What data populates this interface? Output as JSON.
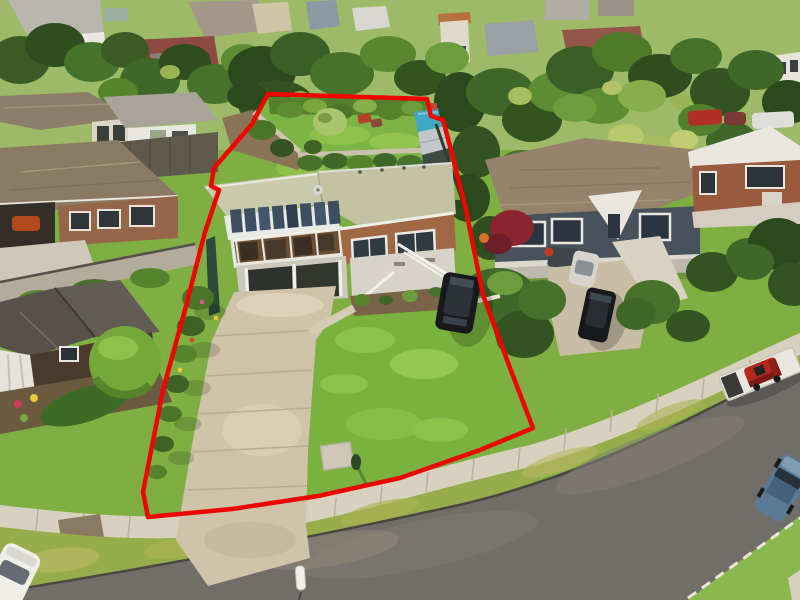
{
  "image": {
    "kind": "aerial-drone-photograph",
    "scene": "Suburban residential street viewed from above with a red property-boundary outline drawn around one lot",
    "subject_lot": "Split-level brick house with glass conservatory, double garage, long concrete driveway, large rear lawn with gardens and sheds, large front lawn",
    "no_text_visible": true
  },
  "colors": {
    "boundary": "#ee0500",
    "base_lawn": "#7fae43",
    "front_lawn": "#79b23e",
    "backyard_lawn": "#7cb445",
    "distant_yard": "#9cba67",
    "road": "#716e69",
    "footpath": "#d9d1bf",
    "berm": "#97ad4c",
    "driveway": "#cfc3aa",
    "subject_roof": "#c9c9ab",
    "subject_brick": "#a06844",
    "sunroom_glass": "#3c4e60",
    "garage_dark": "#33352f",
    "left_roof": "#8a7a64",
    "dark_gable_roof": "#56514a",
    "right_roof": "#97826c",
    "right_walls": "#47525c",
    "far_brick": "#9a5a3e",
    "tarp": "#3fa8c4",
    "tree_dark": "#2f4d1f",
    "tree_mid": "#47722b",
    "tree_light": "#86ae4b",
    "car_black": "#17191c",
    "car_blue": "#5a7a96",
    "car_white": "#f0eee8",
    "mower_red": "#b5281e",
    "marker": "#f2f0ea"
  },
  "objects": {
    "boundary": "red outlined property boundary",
    "subject_house": "house with conservatory, brick wing and double garage",
    "subject_driveway": "long concrete driveway to street",
    "subject_backyard": "rear lawn, garden beds, blue tarp shelter and sheds",
    "subject_front_lawn": "large front lawn with black SUV parked",
    "left_neighbours": "two-storey house, white cottage, brick bungalow, dark gabled house with round bush",
    "right_neighbours": "grey-roofed house with dark walls, brick two-storey house, cars on driveway",
    "street": "curved asphalt road with footpath, grass berms, white marker post",
    "street_vehicles": "trailer with red ride-on mower, blue car, white car"
  }
}
